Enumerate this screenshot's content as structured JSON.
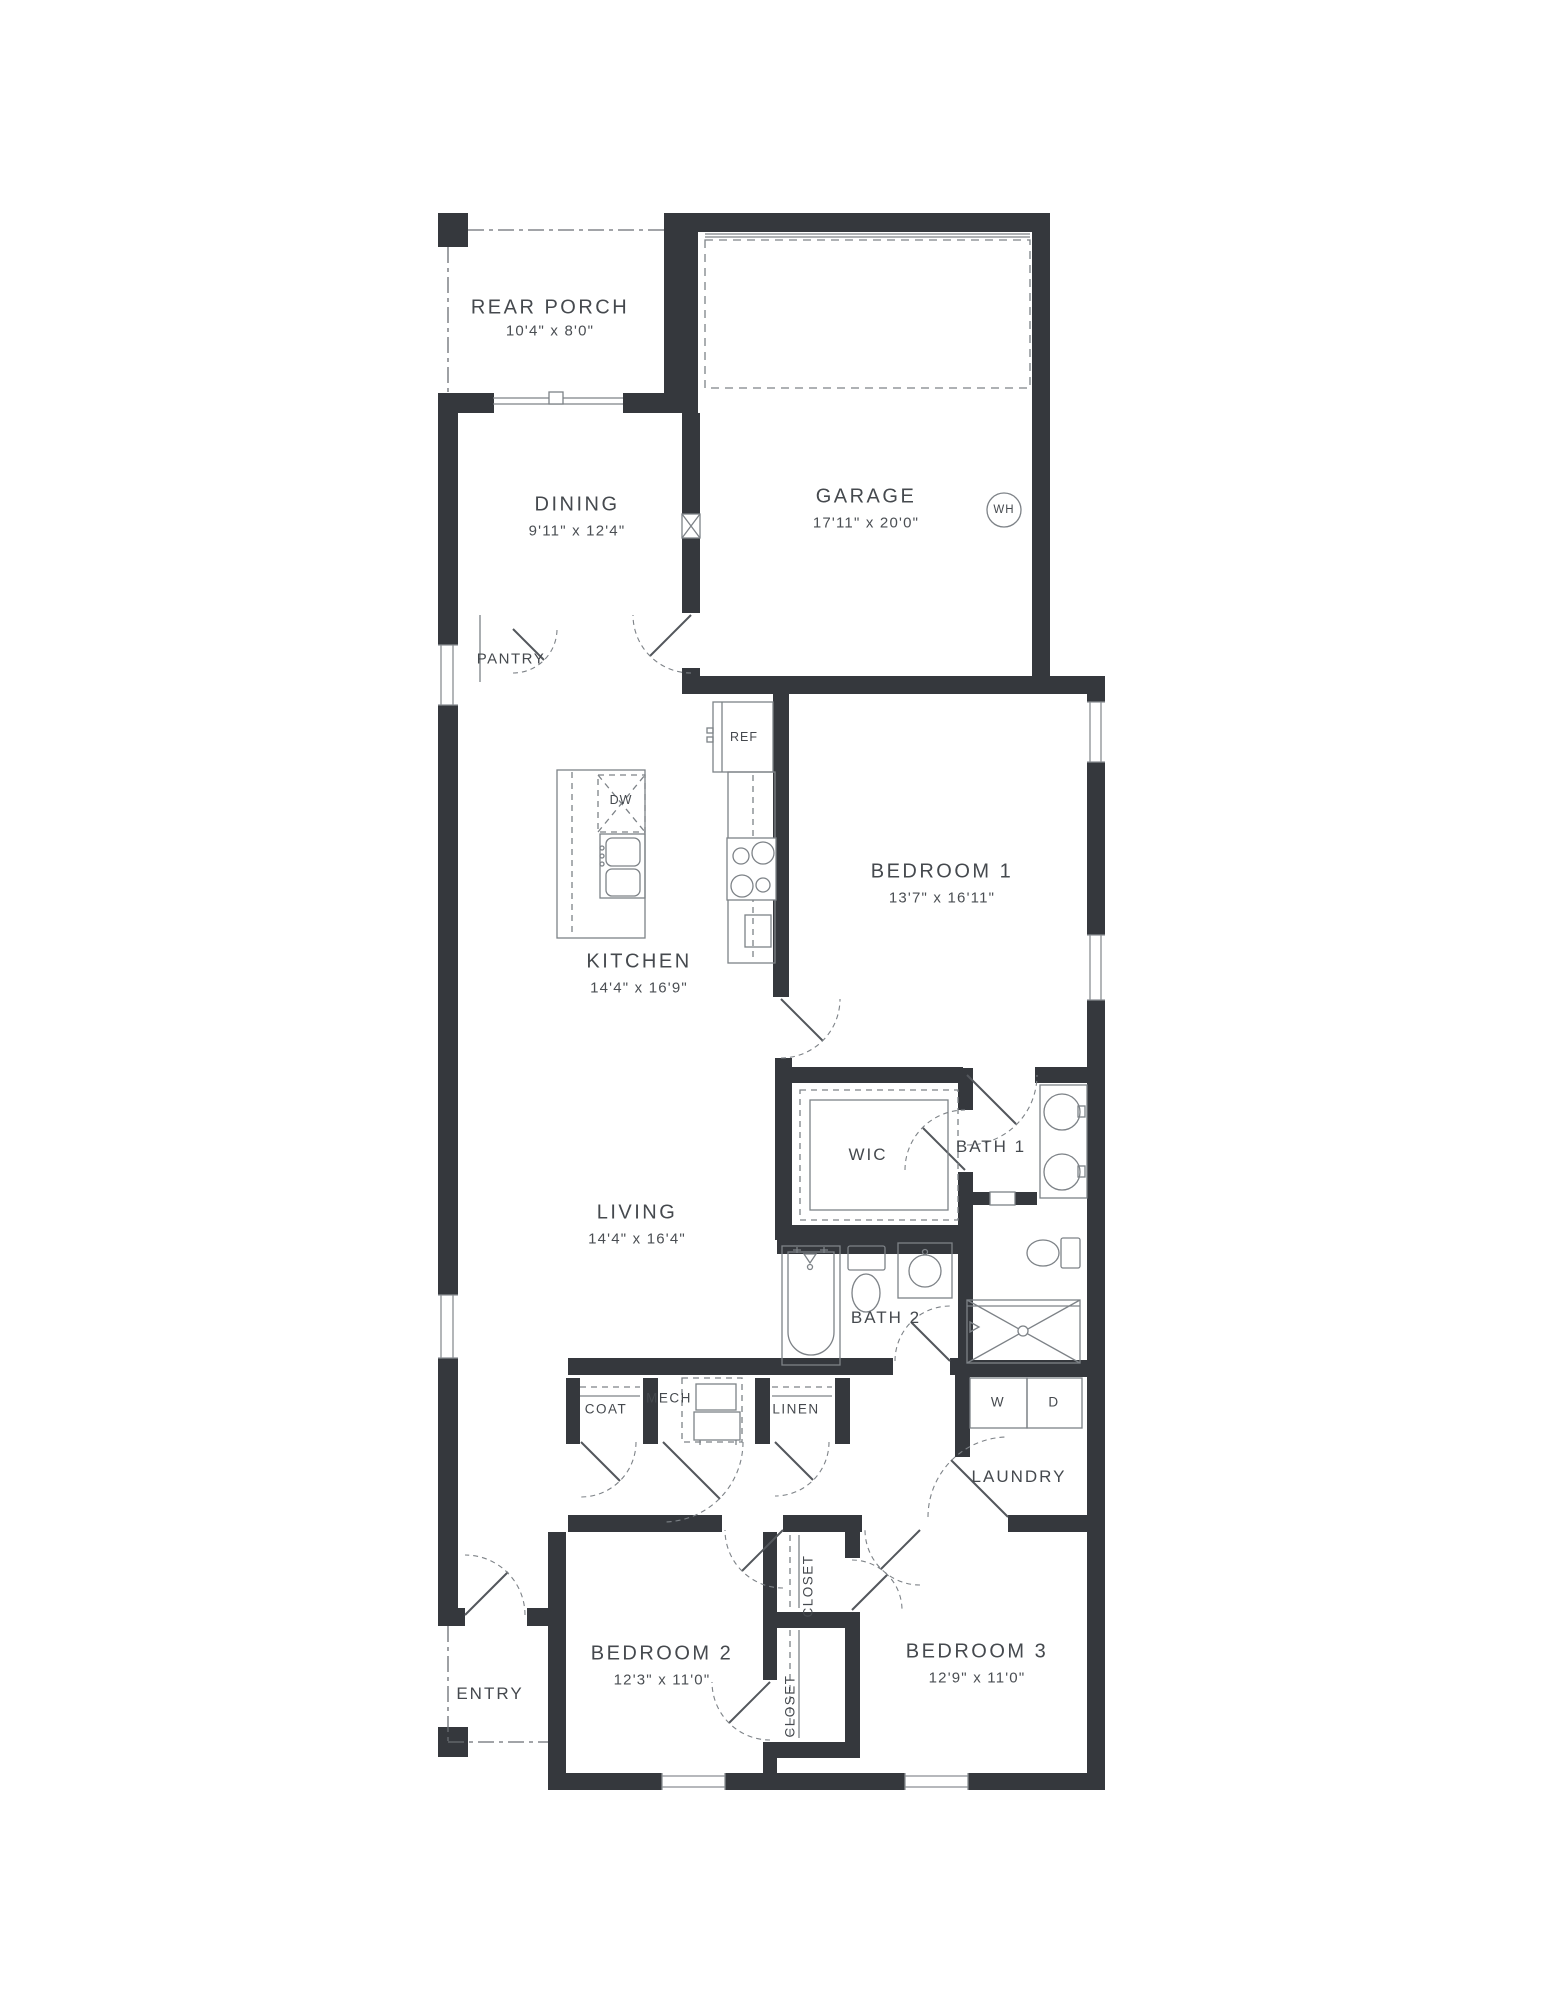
{
  "plan_title": "Floor Plan",
  "rooms": {
    "rear_porch": {
      "label": "REAR PORCH",
      "dims": "10'4\" x 8'0\""
    },
    "garage": {
      "label": "GARAGE",
      "dims": "17'11\" x 20'0\""
    },
    "dining": {
      "label": "DINING",
      "dims": "9'11\" x 12'4\""
    },
    "kitchen": {
      "label": "KITCHEN",
      "dims": "14'4\" x 16'9\""
    },
    "bedroom1": {
      "label": "BEDROOM 1",
      "dims": "13'7\" x 16'11\""
    },
    "living": {
      "label": "LIVING",
      "dims": "14'4\" x 16'4\""
    },
    "bedroom2": {
      "label": "BEDROOM 2",
      "dims": "12'3\" x 11'0\""
    },
    "bedroom3": {
      "label": "BEDROOM 3",
      "dims": "12'9\" x 11'0\""
    },
    "bath1": {
      "label": "BATH 1"
    },
    "bath2": {
      "label": "BATH 2"
    },
    "wic": {
      "label": "WIC"
    },
    "laundry": {
      "label": "LAUNDRY"
    },
    "entry": {
      "label": "ENTRY"
    },
    "pantry": {
      "label": "PANTRY"
    },
    "coat": {
      "label": "COAT"
    },
    "mech": {
      "label": "MECH"
    },
    "linen": {
      "label": "LINEN"
    },
    "closet_bed3": {
      "label": "CLOSET"
    },
    "closet_bed2": {
      "label": "CLOSET"
    }
  },
  "appliances": {
    "refrigerator": "REF",
    "dishwasher": "DW",
    "water_heater": "WH",
    "washer": "W",
    "dryer": "D"
  },
  "colors": {
    "wall": "#35383d",
    "fixture_line": "#7d8287",
    "text": "#45494e"
  }
}
